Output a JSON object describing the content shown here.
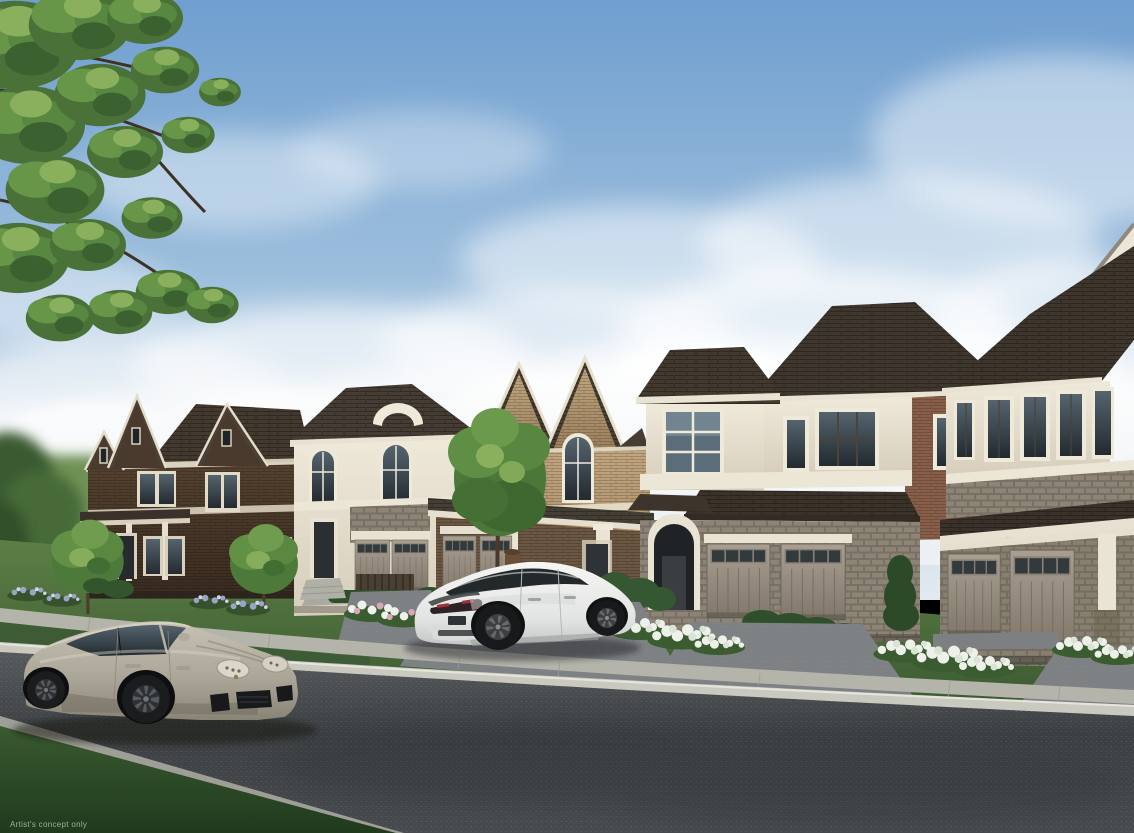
{
  "scene": {
    "type": "architectural-rendering-of-new-home-community",
    "disclaimer": "Artist's concept only"
  },
  "colors": {
    "sky_top": "#6f9ecf",
    "sky_mid": "#9cbedd",
    "sky_low": "#c3d6e7",
    "sky_horizon": "#e2eaf0",
    "cloud": "#f5f8fa",
    "foliage_dark": "#3f6530",
    "foliage_mid": "#5f8c42",
    "foliage_light": "#8db061",
    "lawn": "#4c6f3d",
    "lawn_verge": "#3d5c35",
    "lawn_dark": "#2f4c2a",
    "road": "#3f4345",
    "sidewalk": "#b4b4ab",
    "curb": "#c9c9c0",
    "driveway": "#7e8184",
    "roof": "#453c33",
    "brick_dark": "#4a392d",
    "brick_tan": "#b49a76",
    "brick_red": "#8a5f4a",
    "stucco_cream": "#e7e1d2",
    "stone_grey": "#8d8476",
    "garage_door": "#9a9184",
    "trim_white": "#efeadd",
    "porsche_body": "#b7b1a4",
    "tesla_body": "#ececea",
    "glass_dark": "#262b2f",
    "caliper_yellow": "#c9a62e",
    "flower_white": "#eef2ec",
    "flower_pink": "#d8a8b8",
    "flower_purple": "#9aa4c4",
    "disclaimer_text": "#c9d4c6"
  }
}
